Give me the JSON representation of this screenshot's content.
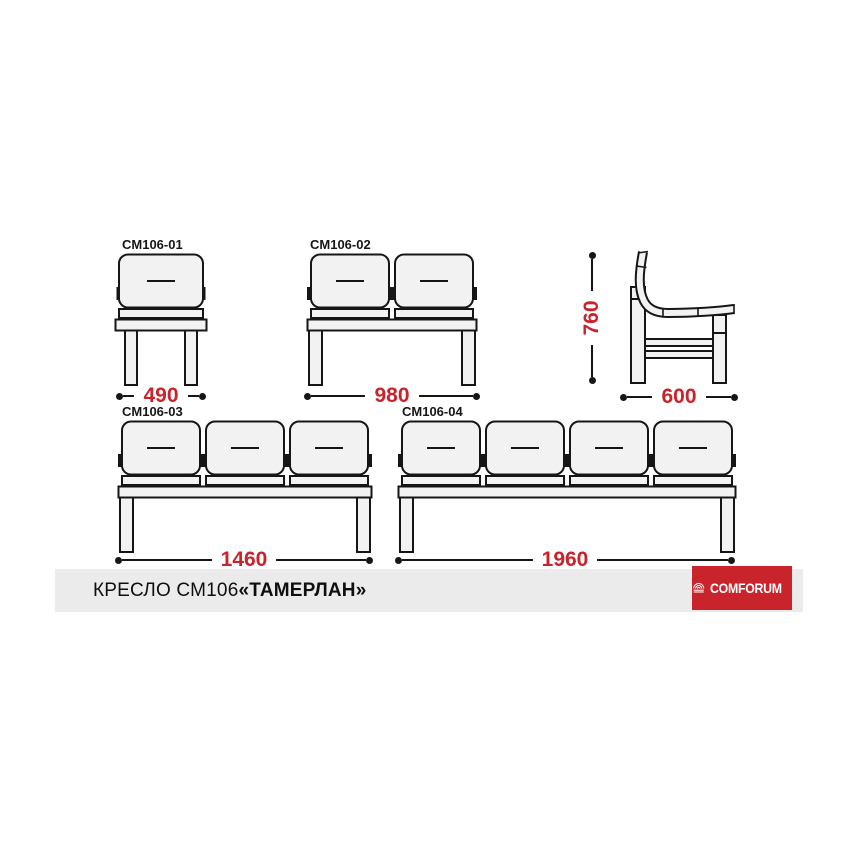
{
  "drawing": {
    "modules": [
      {
        "id": "CM106-01",
        "seats": 1,
        "width_label": "490"
      },
      {
        "id": "CM106-02",
        "seats": 2,
        "width_label": "980"
      },
      {
        "id": "CM106-03",
        "seats": 3,
        "width_label": "1460"
      },
      {
        "id": "CM106-04",
        "seats": 4,
        "width_label": "1960"
      }
    ],
    "side_view": {
      "height_label": "760",
      "depth_label": "600"
    }
  },
  "footer": {
    "title_regular": "КРЕСЛО СМ106 ",
    "title_emphasis": "«ТАМЕРЛАН»"
  },
  "logo": {
    "text": "COMFORUM"
  },
  "colors": {
    "dimension_red": "#c9232b",
    "logo_red": "#c9232b",
    "outline": "#161616",
    "cushion_fill": "#f2f2f2",
    "footer_bar_gray": "#ebebeb"
  }
}
